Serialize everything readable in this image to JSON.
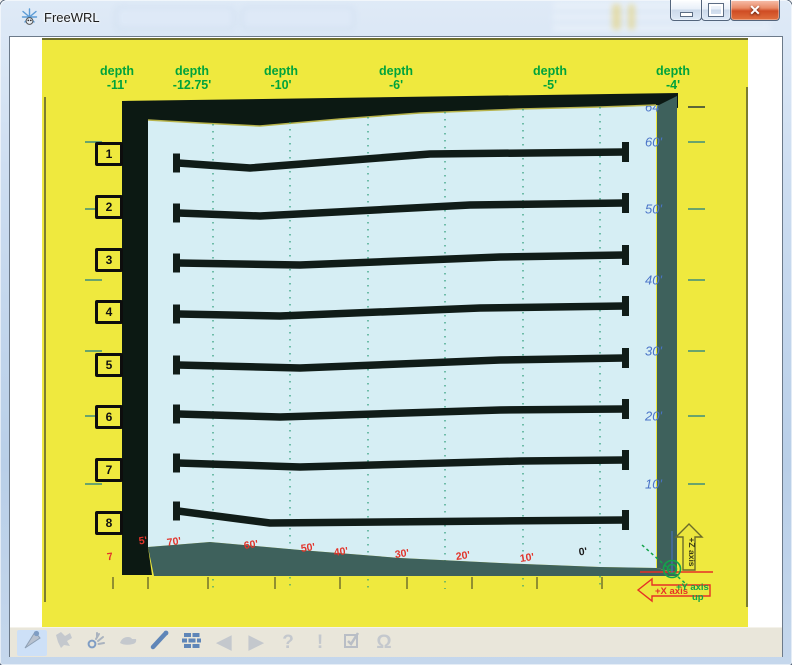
{
  "window": {
    "title": "FreeWRL",
    "buttons": [
      {
        "name": "minimize-button",
        "glyph": "min"
      },
      {
        "name": "maximize-button",
        "glyph": "max"
      },
      {
        "name": "close-button",
        "glyph": "close"
      }
    ]
  },
  "scene": {
    "depth_labels": [
      {
        "word": "depth",
        "value": "-11'",
        "cx": 75
      },
      {
        "word": "depth",
        "value": "-12.75'",
        "cx": 150
      },
      {
        "word": "depth",
        "value": "-10'",
        "cx": 239
      },
      {
        "word": "depth",
        "value": "-6'",
        "cx": 354
      },
      {
        "word": "depth",
        "value": "-5'",
        "cx": 508
      },
      {
        "word": "depth",
        "value": "-4'",
        "cx": 631
      }
    ],
    "row_markers": [
      {
        "label": "1",
        "cy": 114
      },
      {
        "label": "2",
        "cy": 167
      },
      {
        "label": "3",
        "cy": 220
      },
      {
        "label": "4",
        "cy": 272
      },
      {
        "label": "5",
        "cy": 325
      },
      {
        "label": "6",
        "cy": 377
      },
      {
        "label": "7",
        "cy": 430
      },
      {
        "label": "8",
        "cy": 483
      }
    ],
    "right_scale": [
      {
        "text": "64'",
        "cy": 67,
        "clipped": true
      },
      {
        "text": "60'",
        "cy": 102,
        "clipped": false
      },
      {
        "text": "50'",
        "cy": 169,
        "clipped": false
      },
      {
        "text": "40'",
        "cy": 240,
        "clipped": false
      },
      {
        "text": "30'",
        "cy": 311,
        "clipped": false
      },
      {
        "text": "20'",
        "cy": 376,
        "clipped": false
      },
      {
        "text": "10'",
        "cy": 444,
        "clipped": false
      }
    ],
    "bottom_scale": [
      {
        "text": "7",
        "cx": 68,
        "cy": 517,
        "color": "#e2342b"
      },
      {
        "text": "5'",
        "cx": 101,
        "cy": 501,
        "color": "#e2342b"
      },
      {
        "text": "70'",
        "cx": 132,
        "cy": 502,
        "color": "#e2342b"
      },
      {
        "text": "60'",
        "cx": 209,
        "cy": 505,
        "color": "#e2342b"
      },
      {
        "text": "50'",
        "cx": 266,
        "cy": 508,
        "color": "#e2342b"
      },
      {
        "text": "40'",
        "cx": 299,
        "cy": 512,
        "color": "#e2342b"
      },
      {
        "text": "30'",
        "cx": 360,
        "cy": 514,
        "color": "#e2342b"
      },
      {
        "text": "20'",
        "cx": 421,
        "cy": 516,
        "color": "#e2342b"
      },
      {
        "text": "10'",
        "cx": 485,
        "cy": 518,
        "color": "#e2342b"
      },
      {
        "text": "0'",
        "cx": 541,
        "cy": 512,
        "color": "#1a1a1a"
      }
    ],
    "bars": [
      {
        "pts": "136,123 208,128 388,114 582,112"
      },
      {
        "pts": "136,173 218,176 428,165 582,163"
      },
      {
        "pts": "136,223 258,225 458,217 582,215"
      },
      {
        "pts": "136,274 238,276 438,268 582,266"
      },
      {
        "pts": "136,325 258,328 458,320 582,318"
      },
      {
        "pts": "136,374 238,377 458,370 582,369"
      },
      {
        "pts": "136,423 258,427 478,421 582,420"
      },
      {
        "pts": "136,471 228,483 458,481 582,480"
      }
    ],
    "gridlines": [
      [
        171,
        84
      ],
      [
        248,
        82
      ],
      [
        326,
        77
      ],
      [
        403,
        72
      ],
      [
        481,
        69
      ],
      [
        558,
        67
      ]
    ],
    "gridline_bottom_y": 549,
    "bottom_tick_xs": [
      71,
      106,
      166,
      233,
      298,
      365,
      430,
      495,
      560
    ],
    "right_tick_ys": [
      67,
      102,
      169,
      240,
      311,
      376,
      444
    ],
    "left_tick_ys": [
      102,
      169,
      240,
      311,
      376,
      444
    ],
    "axis": {
      "x_label": "+X axis",
      "z_label": "+Z axis",
      "y_label_line1": "+Y axis",
      "y_label_line2": "up"
    }
  },
  "toolbar": {
    "items": [
      {
        "name": "walk-icon",
        "active": true,
        "glyph": ""
      },
      {
        "name": "fly-icon",
        "active": false,
        "glyph": ""
      },
      {
        "name": "examine-icon",
        "active": false,
        "glyph": ""
      },
      {
        "name": "mouse-icon",
        "active": false,
        "glyph": ""
      },
      {
        "name": "pen-icon",
        "active": false,
        "glyph": ""
      },
      {
        "name": "bricks-icon",
        "active": false,
        "glyph": ""
      },
      {
        "name": "back-icon",
        "active": false,
        "glyph": "◀"
      },
      {
        "name": "forward-icon",
        "active": false,
        "glyph": "▶"
      },
      {
        "name": "help-icon",
        "active": false,
        "glyph": "?"
      },
      {
        "name": "messages-icon",
        "active": false,
        "glyph": "!"
      },
      {
        "name": "checkbox-icon",
        "active": false,
        "glyph": ""
      },
      {
        "name": "headphones-icon",
        "active": false,
        "glyph": "Ω"
      }
    ]
  },
  "colors": {
    "canvas_yellow": "#efe93e",
    "panel_blue": "#d6eef4",
    "frame_dark": "#0c1913",
    "teal": "#3e615c",
    "green_label": "#00a33c",
    "blue_label": "#4a74c8",
    "red_label": "#e2342b",
    "olive": "#72722c",
    "grid_green": "#2a9b77",
    "bar_black": "#101c18"
  }
}
